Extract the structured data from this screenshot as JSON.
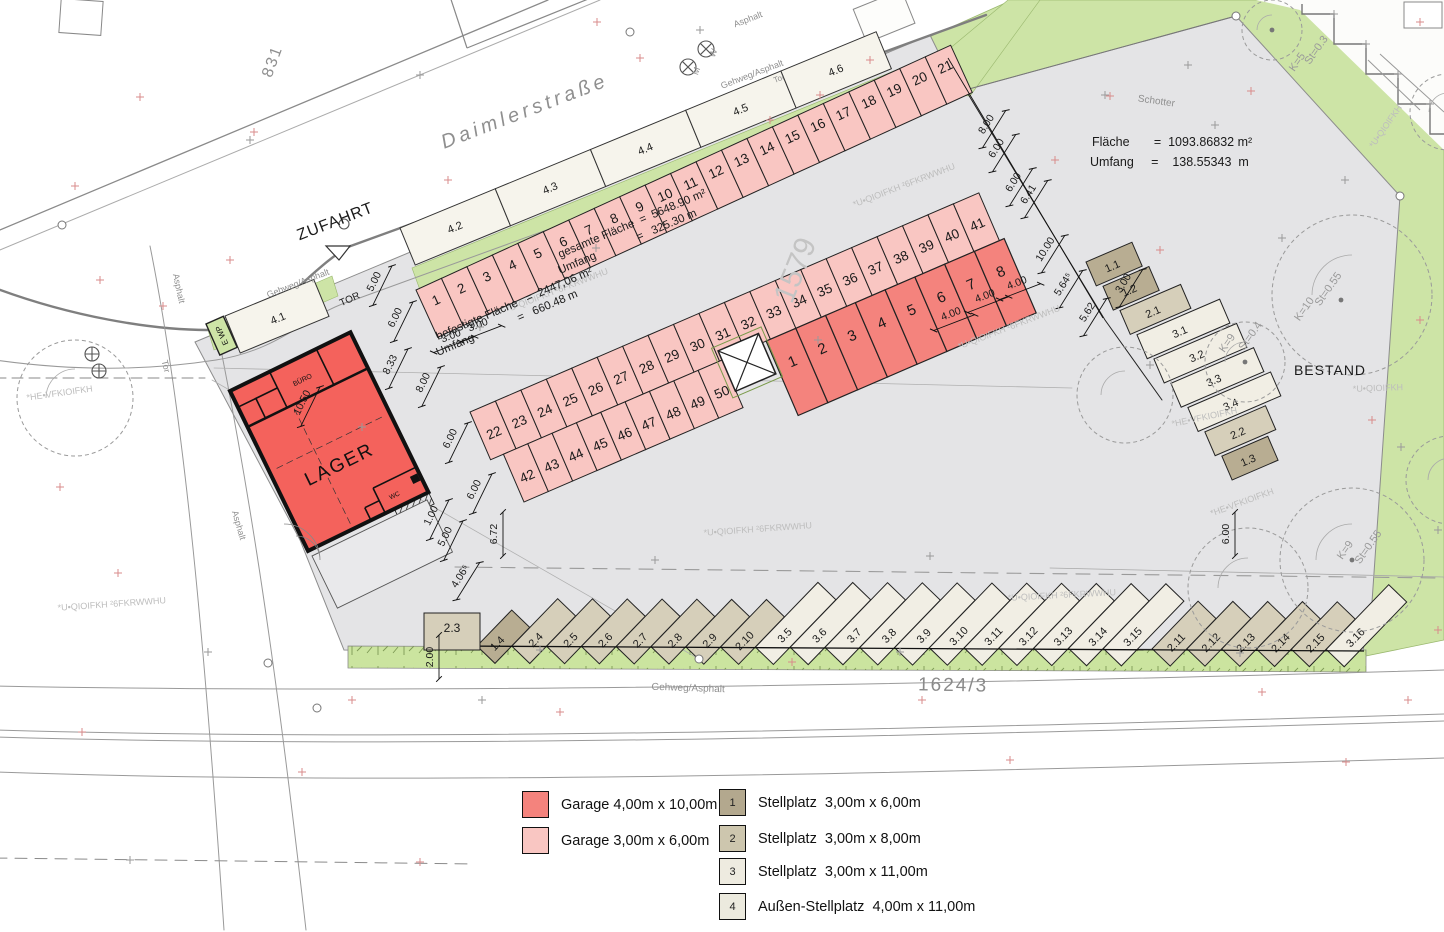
{
  "labels": {
    "street": "Daimlerstraße",
    "zufahrt": "ZUFAHRT",
    "parcel_left": "831",
    "parcel_bottom": "1624/3",
    "parcel_faint": "1579",
    "bestand": "BESTAND",
    "schotter": "Schotter"
  },
  "stats": {
    "schotter": [
      "Fläche       =  1093.86832 m²",
      "Umfang     =    138.55343  m"
    ],
    "gesamt": [
      "gesamte Fläche  =  5648.90 m²",
      "Umfang              =   325.30 m"
    ],
    "befestigt": [
      "befestigte Fläche   =  2447,06 m²",
      "Umfang               =   660.48 m"
    ]
  },
  "building": {
    "name": "LAGER",
    "room1": "BÜRO",
    "room2": "WC",
    "wp": "E WP"
  },
  "rows": {
    "top_numbers": [
      "1",
      "2",
      "3",
      "4",
      "5",
      "6",
      "7",
      "8",
      "9",
      "10",
      "11",
      "12",
      "13",
      "14",
      "15",
      "16",
      "17",
      "18",
      "19",
      "20",
      "21"
    ],
    "top_plots": [
      "4.2",
      "4.3",
      "4.4",
      "4.5",
      "4.6"
    ],
    "plot_41": "4.1",
    "mid_upper": [
      "22",
      "23",
      "24",
      "25",
      "26",
      "27",
      "28",
      "29",
      "30",
      "31",
      "32",
      "33",
      "34",
      "35",
      "36",
      "37",
      "38",
      "39",
      "40",
      "41"
    ],
    "mid_lower": [
      "42",
      "43",
      "44",
      "45",
      "46",
      "47",
      "48",
      "49",
      "50"
    ],
    "red_garages": [
      "1",
      "2",
      "3",
      "4",
      "5",
      "6",
      "7",
      "8"
    ],
    "box_23": "2.3",
    "diag": [
      {
        "l": "1.4",
        "t": 1
      },
      {
        "l": "2.4",
        "t": 2
      },
      {
        "l": "2.5",
        "t": 2
      },
      {
        "l": "2.6",
        "t": 2
      },
      {
        "l": "2.7",
        "t": 2
      },
      {
        "l": "2.8",
        "t": 2
      },
      {
        "l": "2.9",
        "t": 2
      },
      {
        "l": "2.10",
        "t": 2
      },
      {
        "l": "3.5",
        "t": 3
      },
      {
        "l": "3.6",
        "t": 3
      },
      {
        "l": "3.7",
        "t": 3
      },
      {
        "l": "3.8",
        "t": 3
      },
      {
        "l": "3.9",
        "t": 3
      },
      {
        "l": "3.10",
        "t": 3
      },
      {
        "l": "3.11",
        "t": 3
      },
      {
        "l": "3.12",
        "t": 3
      },
      {
        "l": "3.13",
        "t": 3
      },
      {
        "l": "3.14",
        "t": 3
      },
      {
        "l": "3.15",
        "t": 3
      },
      {
        "l": "2.11",
        "t": 2,
        "dx": 14
      },
      {
        "l": "2.12",
        "t": 2
      },
      {
        "l": "2.13",
        "t": 2
      },
      {
        "l": "2.14",
        "t": 2
      },
      {
        "l": "2.15",
        "t": 2
      },
      {
        "l": "3.16",
        "t": 3
      }
    ],
    "right_col": [
      {
        "l": "1.1",
        "t": 1,
        "len": 50
      },
      {
        "l": "1.2",
        "t": 1,
        "len": 50
      },
      {
        "l": "2.1",
        "t": 2,
        "len": 66
      },
      {
        "l": "3.1",
        "t": 3,
        "len": 90
      },
      {
        "l": "3.2",
        "t": 3,
        "len": 90
      },
      {
        "l": "3.3",
        "t": 3,
        "len": 90
      },
      {
        "l": "3.4",
        "t": 3,
        "len": 90
      },
      {
        "l": "2.2",
        "t": 2,
        "len": 66
      },
      {
        "l": "1.3",
        "t": 1,
        "len": 50
      }
    ]
  },
  "dims": [
    [
      "5.00",
      377,
      283,
      -64
    ],
    [
      "6.00",
      398,
      319,
      -64
    ],
    [
      "8.33",
      393,
      366,
      -64
    ],
    [
      "8.00",
      426,
      384,
      -64
    ],
    [
      "3.00",
      452,
      339,
      -21
    ],
    [
      "3.00",
      479,
      328,
      -21
    ],
    [
      "6.00",
      453,
      440,
      -64
    ],
    [
      "6.00",
      477,
      491,
      -64
    ],
    [
      "1.00",
      434,
      517,
      -64
    ],
    [
      "5.00",
      448,
      538,
      -64
    ],
    [
      "6.72",
      497,
      534,
      -90
    ],
    [
      "4.06⁵",
      463,
      578,
      -58
    ],
    [
      "2.00",
      433,
      657,
      -90
    ],
    [
      "10.50",
      305,
      404,
      -64
    ],
    [
      "8.00",
      989,
      126,
      -58
    ],
    [
      "6.00",
      999,
      150,
      -58
    ],
    [
      "6.00",
      1016,
      184,
      -58
    ],
    [
      "6.41",
      1031,
      196,
      -58
    ],
    [
      "10.00",
      1048,
      251,
      -58
    ],
    [
      "5.64⁵",
      1066,
      286,
      -58
    ],
    [
      "5.62",
      1090,
      314,
      -58
    ],
    [
      "3.00",
      1126,
      285,
      -58
    ],
    [
      "4.00",
      952,
      317,
      -21
    ],
    [
      "4.00",
      986,
      299,
      -21
    ],
    [
      "4.00",
      1018,
      286,
      -21
    ],
    [
      "6.00",
      1229,
      534,
      -90
    ]
  ],
  "tree_labels": [
    [
      "St=0.3",
      1319,
      52,
      -55
    ],
    [
      "K=5",
      1300,
      64,
      -55
    ],
    [
      "St=0.55",
      1331,
      291,
      -55
    ],
    [
      "K=10",
      1307,
      311,
      -55
    ],
    [
      "St=0.4",
      1253,
      338,
      -55
    ],
    [
      "K=9",
      1230,
      345,
      -55
    ],
    [
      "St=0.55",
      1371,
      549,
      -55
    ],
    [
      "K=9",
      1348,
      552,
      -55
    ]
  ],
  "faded_labels": [
    [
      "*U•QIOIFKH ²6FKRWWHU",
      558,
      293,
      -21
    ],
    [
      "*U•QIOIFKH ²6FKRWWHU",
      905,
      188,
      -21
    ],
    [
      "*U•QIOIFKH ²6FKRWWHU",
      1010,
      330,
      -21
    ],
    [
      "*U•QIOIFKH ²6FKRWWHU",
      758,
      532,
      -4
    ],
    [
      "*U•QIOIFKH ²6FKRWWHU",
      112,
      607,
      -4
    ],
    [
      "*U•QIOIFKH ²6FKRWWHU",
      1062,
      598,
      -3
    ],
    [
      "*U•QIOIFKH",
      1388,
      128,
      -55
    ],
    [
      "*U•QIOIFKH",
      1378,
      391,
      -2
    ],
    [
      "*HE•VFKIOIFKH",
      60,
      396,
      -8
    ],
    [
      "*HE•VFKIOIFKH",
      1205,
      420,
      -12
    ],
    [
      "*HE•VFKIOIFKH",
      1243,
      505,
      -20
    ]
  ],
  "misc_labels": [
    {
      "t": "Gehweg/Asphalt",
      "x": 299,
      "y": 286,
      "r": -21,
      "s": 9,
      "c": "gray"
    },
    {
      "t": "Gehweg/Asphalt",
      "x": 753,
      "y": 77,
      "r": -21,
      "s": 9,
      "c": "gray"
    },
    {
      "t": "Gehweg/Asphalt",
      "x": 688,
      "y": 691,
      "r": 2,
      "s": 10,
      "c": "gray"
    },
    {
      "t": "Asphalt",
      "x": 749,
      "y": 22,
      "r": -21,
      "s": 9,
      "c": "gray"
    },
    {
      "t": "Asphalt",
      "x": 176,
      "y": 289,
      "r": 78,
      "s": 9,
      "c": "gray"
    },
    {
      "t": "Asphalt",
      "x": 236,
      "y": 526,
      "r": 74,
      "s": 9,
      "c": "gray"
    },
    {
      "t": "Tor",
      "x": 780,
      "y": 81,
      "r": -21,
      "s": 8,
      "c": "gray"
    },
    {
      "t": "Tor",
      "x": 163,
      "y": 367,
      "r": 76,
      "s": 9,
      "c": "gray"
    },
    {
      "t": "TOR",
      "x": 351,
      "y": 302,
      "r": -24,
      "s": 10,
      "c": "black"
    },
    {
      "t": "W",
      "x": 716,
      "y": 54,
      "r": -70,
      "s": 9,
      "c": "gray"
    },
    {
      "t": "M",
      "x": 699,
      "y": 72,
      "r": -70,
      "s": 9,
      "c": "gray"
    }
  ],
  "legend": {
    "garage": [
      {
        "hex": "#f4837d",
        "label": "Garage 4,00m x 10,00m"
      },
      {
        "hex": "#f9c6c2",
        "label": "Garage 3,00m x 6,00m"
      }
    ],
    "stellplatz": [
      {
        "num": "1",
        "hex": "#b3a88e",
        "label": "Stellplatz  3,00m x 6,00m"
      },
      {
        "num": "2",
        "hex": "#cdc6ae",
        "label": "Stellplatz  3,00m x 8,00m"
      },
      {
        "num": "3",
        "hex": "#eeebe0",
        "label": "Stellplatz  3,00m x 11,00m"
      },
      {
        "num": "4",
        "hex": "#eceade",
        "label": "Außen-Stellplatz  4,00m x 11,00m"
      }
    ]
  },
  "marks": {
    "red": [
      [
        75,
        186
      ],
      [
        140,
        97
      ],
      [
        100,
        280
      ],
      [
        163,
        306
      ],
      [
        230,
        260
      ],
      [
        254,
        132
      ],
      [
        448,
        180
      ],
      [
        597,
        22
      ],
      [
        640,
        58
      ],
      [
        770,
        120
      ],
      [
        820,
        95
      ],
      [
        870,
        60
      ],
      [
        1110,
        96
      ],
      [
        1251,
        91
      ],
      [
        1420,
        22
      ],
      [
        1055,
        160
      ],
      [
        1160,
        250
      ],
      [
        1420,
        320
      ],
      [
        1372,
        420
      ],
      [
        1438,
        630
      ],
      [
        352,
        700
      ],
      [
        560,
        712
      ],
      [
        792,
        662
      ],
      [
        922,
        700
      ],
      [
        1262,
        692
      ],
      [
        1408,
        700
      ],
      [
        82,
        732
      ],
      [
        302,
        772
      ],
      [
        1346,
        762
      ],
      [
        420,
        862
      ],
      [
        118,
        573
      ],
      [
        60,
        487
      ],
      [
        1010,
        760
      ]
    ],
    "gray": [
      [
        250,
        140
      ],
      [
        420,
        75
      ],
      [
        700,
        30
      ],
      [
        362,
        427
      ],
      [
        480,
        327
      ],
      [
        596,
        248
      ],
      [
        1105,
        95
      ],
      [
        1215,
        125
      ],
      [
        1345,
        180
      ],
      [
        1150,
        365
      ],
      [
        930,
        556
      ],
      [
        655,
        560
      ],
      [
        482,
        700
      ],
      [
        130,
        860
      ],
      [
        1334,
        14
      ],
      [
        1366,
        44
      ],
      [
        1398,
        74
      ],
      [
        1430,
        104
      ],
      [
        818,
        340
      ],
      [
        1188,
        65
      ],
      [
        1282,
        238
      ],
      [
        1401,
        447
      ],
      [
        1438,
        530
      ],
      [
        208,
        652
      ],
      [
        540,
        650
      ],
      [
        900,
        652
      ],
      [
        1240,
        653
      ]
    ]
  },
  "trees": {
    "crowns": [
      [
        1272,
        30,
        30
      ],
      [
        1352,
        295,
        80
      ],
      [
        1245,
        362,
        40
      ],
      [
        1125,
        395,
        48
      ],
      [
        1352,
        560,
        72
      ],
      [
        1248,
        588,
        60
      ],
      [
        75,
        398,
        58
      ],
      [
        1448,
        112,
        38
      ],
      [
        1450,
        480,
        44
      ]
    ],
    "dots": [
      [
        1272,
        30
      ],
      [
        1341,
        300
      ],
      [
        1245,
        362
      ],
      [
        1352,
        560
      ]
    ]
  },
  "colors": {
    "lager": "#f4625c",
    "red": "#f4837d",
    "pink": "#f9c6c2",
    "tan1": "#b8ad92",
    "tan2": "#d6cfba",
    "white3": "#f1eee4",
    "cream": "#f6f4ec",
    "green": "#cde4a6",
    "green_strip": "#cbe49f",
    "gray": "#e4e4e6"
  }
}
